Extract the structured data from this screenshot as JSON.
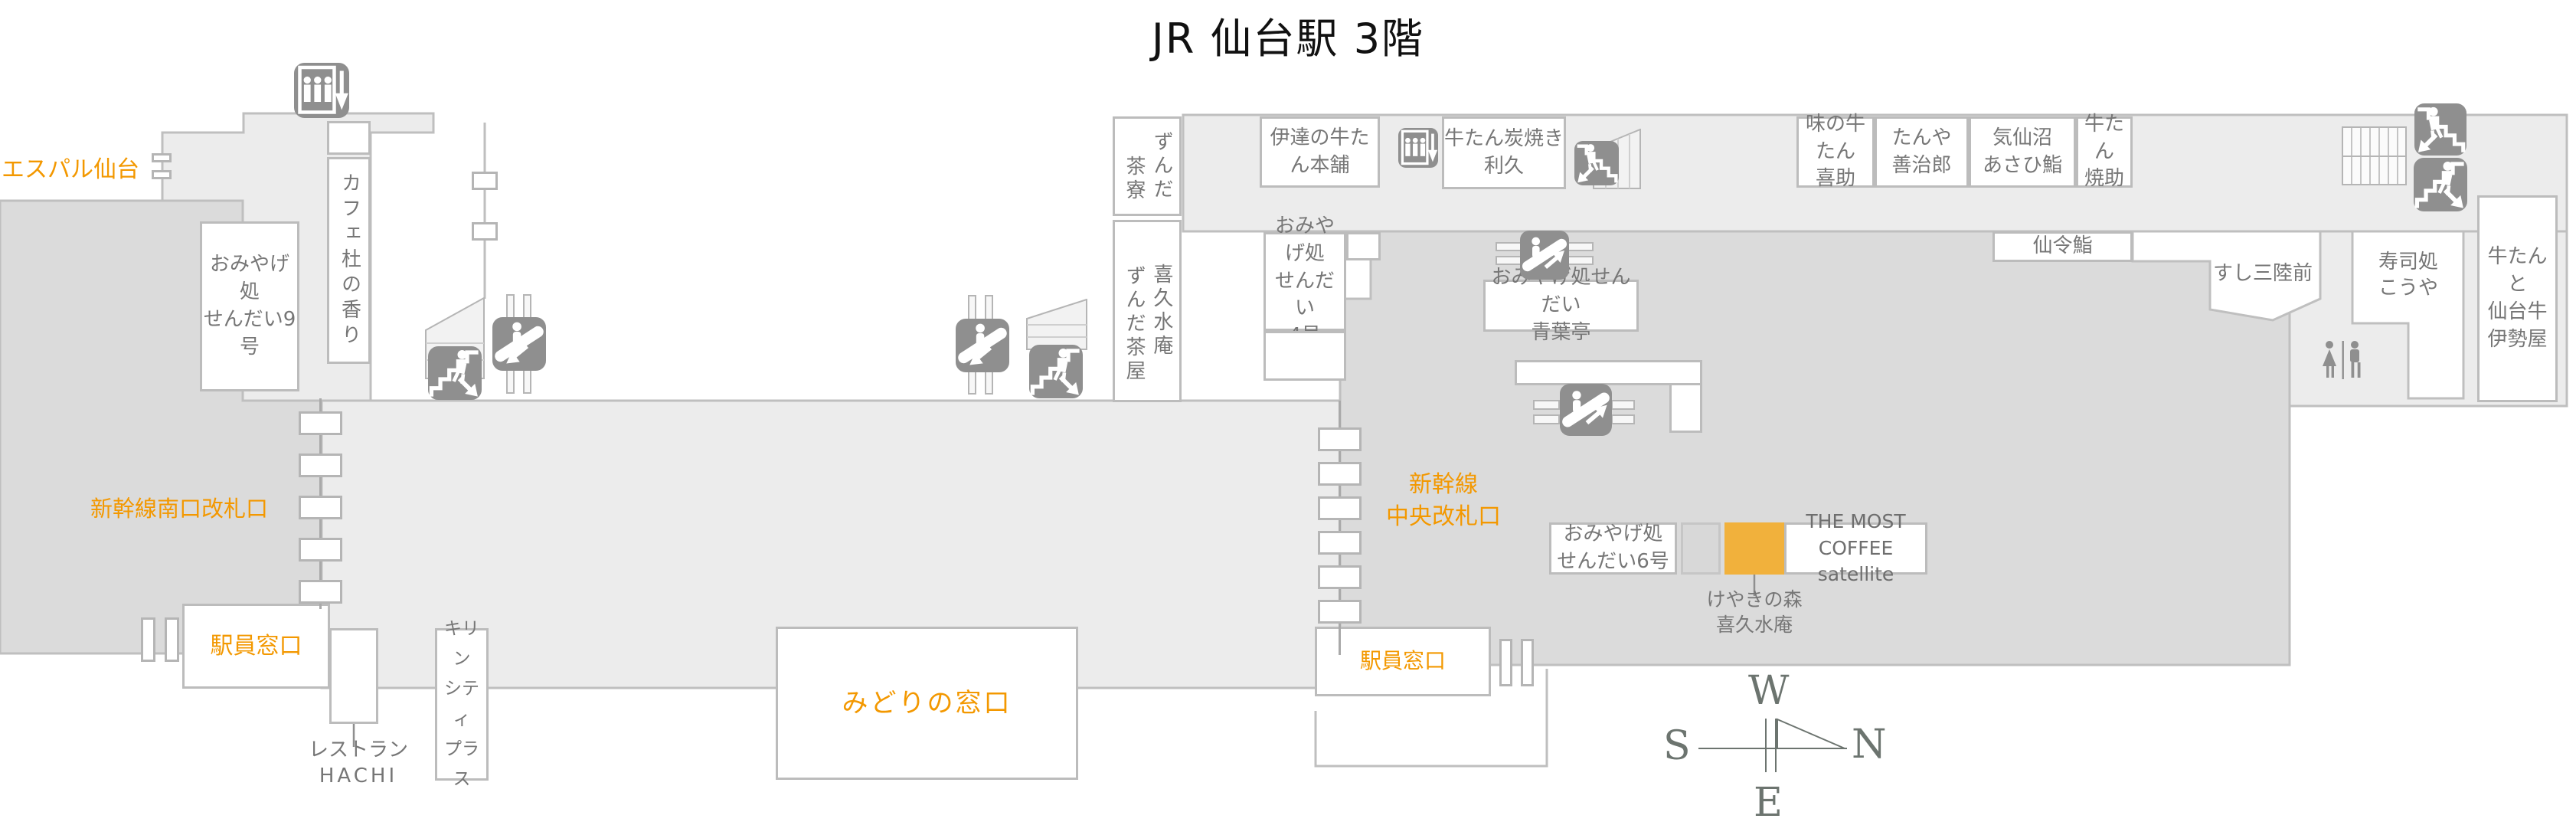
{
  "title": "JR 仙台駅 3階",
  "colors": {
    "accent_orange": "#F39800",
    "highlight_yellow": "#F1B13C",
    "floor_light": "#ECECEC",
    "floor_dark": "#DBDBDB",
    "outline": "#BFBFBF",
    "icon_gray": "#8F8F8F",
    "text_gray": "#767676",
    "compass_green": "#6C746F"
  },
  "labels": {
    "espal": "エスパル仙台",
    "south_gate": "新幹線南口改札口",
    "central_gate": [
      "新幹線",
      "中央改札口"
    ],
    "staff_window_left": "駅員窓口",
    "staff_window_right": "駅員窓口",
    "midori_window": "みどりの窓口",
    "keyaki": [
      "けやきの森",
      "喜久水庵"
    ],
    "restaurant_hachi": [
      "レストラン",
      "HACHI"
    ]
  },
  "shops": {
    "omiyage9": [
      "おみやげ処",
      "せんだい9号"
    ],
    "cafe_mori": "カフェ杜の香り",
    "zunda_saryo": [
      "ずんだ",
      "茶寮"
    ],
    "kikusui_zunda": [
      "喜久水庵",
      "ずんだ茶屋"
    ],
    "date_honpo": "伊達の牛たん本舗",
    "rikyu": [
      "牛たん炭焼き",
      "利久"
    ],
    "kisuke": [
      "味の牛たん",
      "喜助"
    ],
    "zenjiro": [
      "たんや",
      "善治郎"
    ],
    "asahi": [
      "気仙沼",
      "あさひ鮨"
    ],
    "yakisuke": [
      "牛たん",
      "焼助"
    ],
    "senrei": "仙令鮨",
    "sanriku": "すし三陸前",
    "kouya": [
      "寿司処",
      "こうや"
    ],
    "iseya": [
      "牛たんと",
      "仙台牛",
      "伊勢屋"
    ],
    "omiyage4": [
      "おみやげ処",
      "せんだい",
      "4号"
    ],
    "aobatei": [
      "おみやげ処せんだい",
      "青葉亭"
    ],
    "omiyage6": [
      "おみやげ処",
      "せんだい6号"
    ],
    "most_coffee": [
      "THE MOST COFFEE",
      "satellite"
    ],
    "kirin": [
      "キリン",
      "シティ",
      "プラス"
    ]
  },
  "compass": {
    "west": "W",
    "south": "S",
    "north": "N",
    "east": "E"
  }
}
